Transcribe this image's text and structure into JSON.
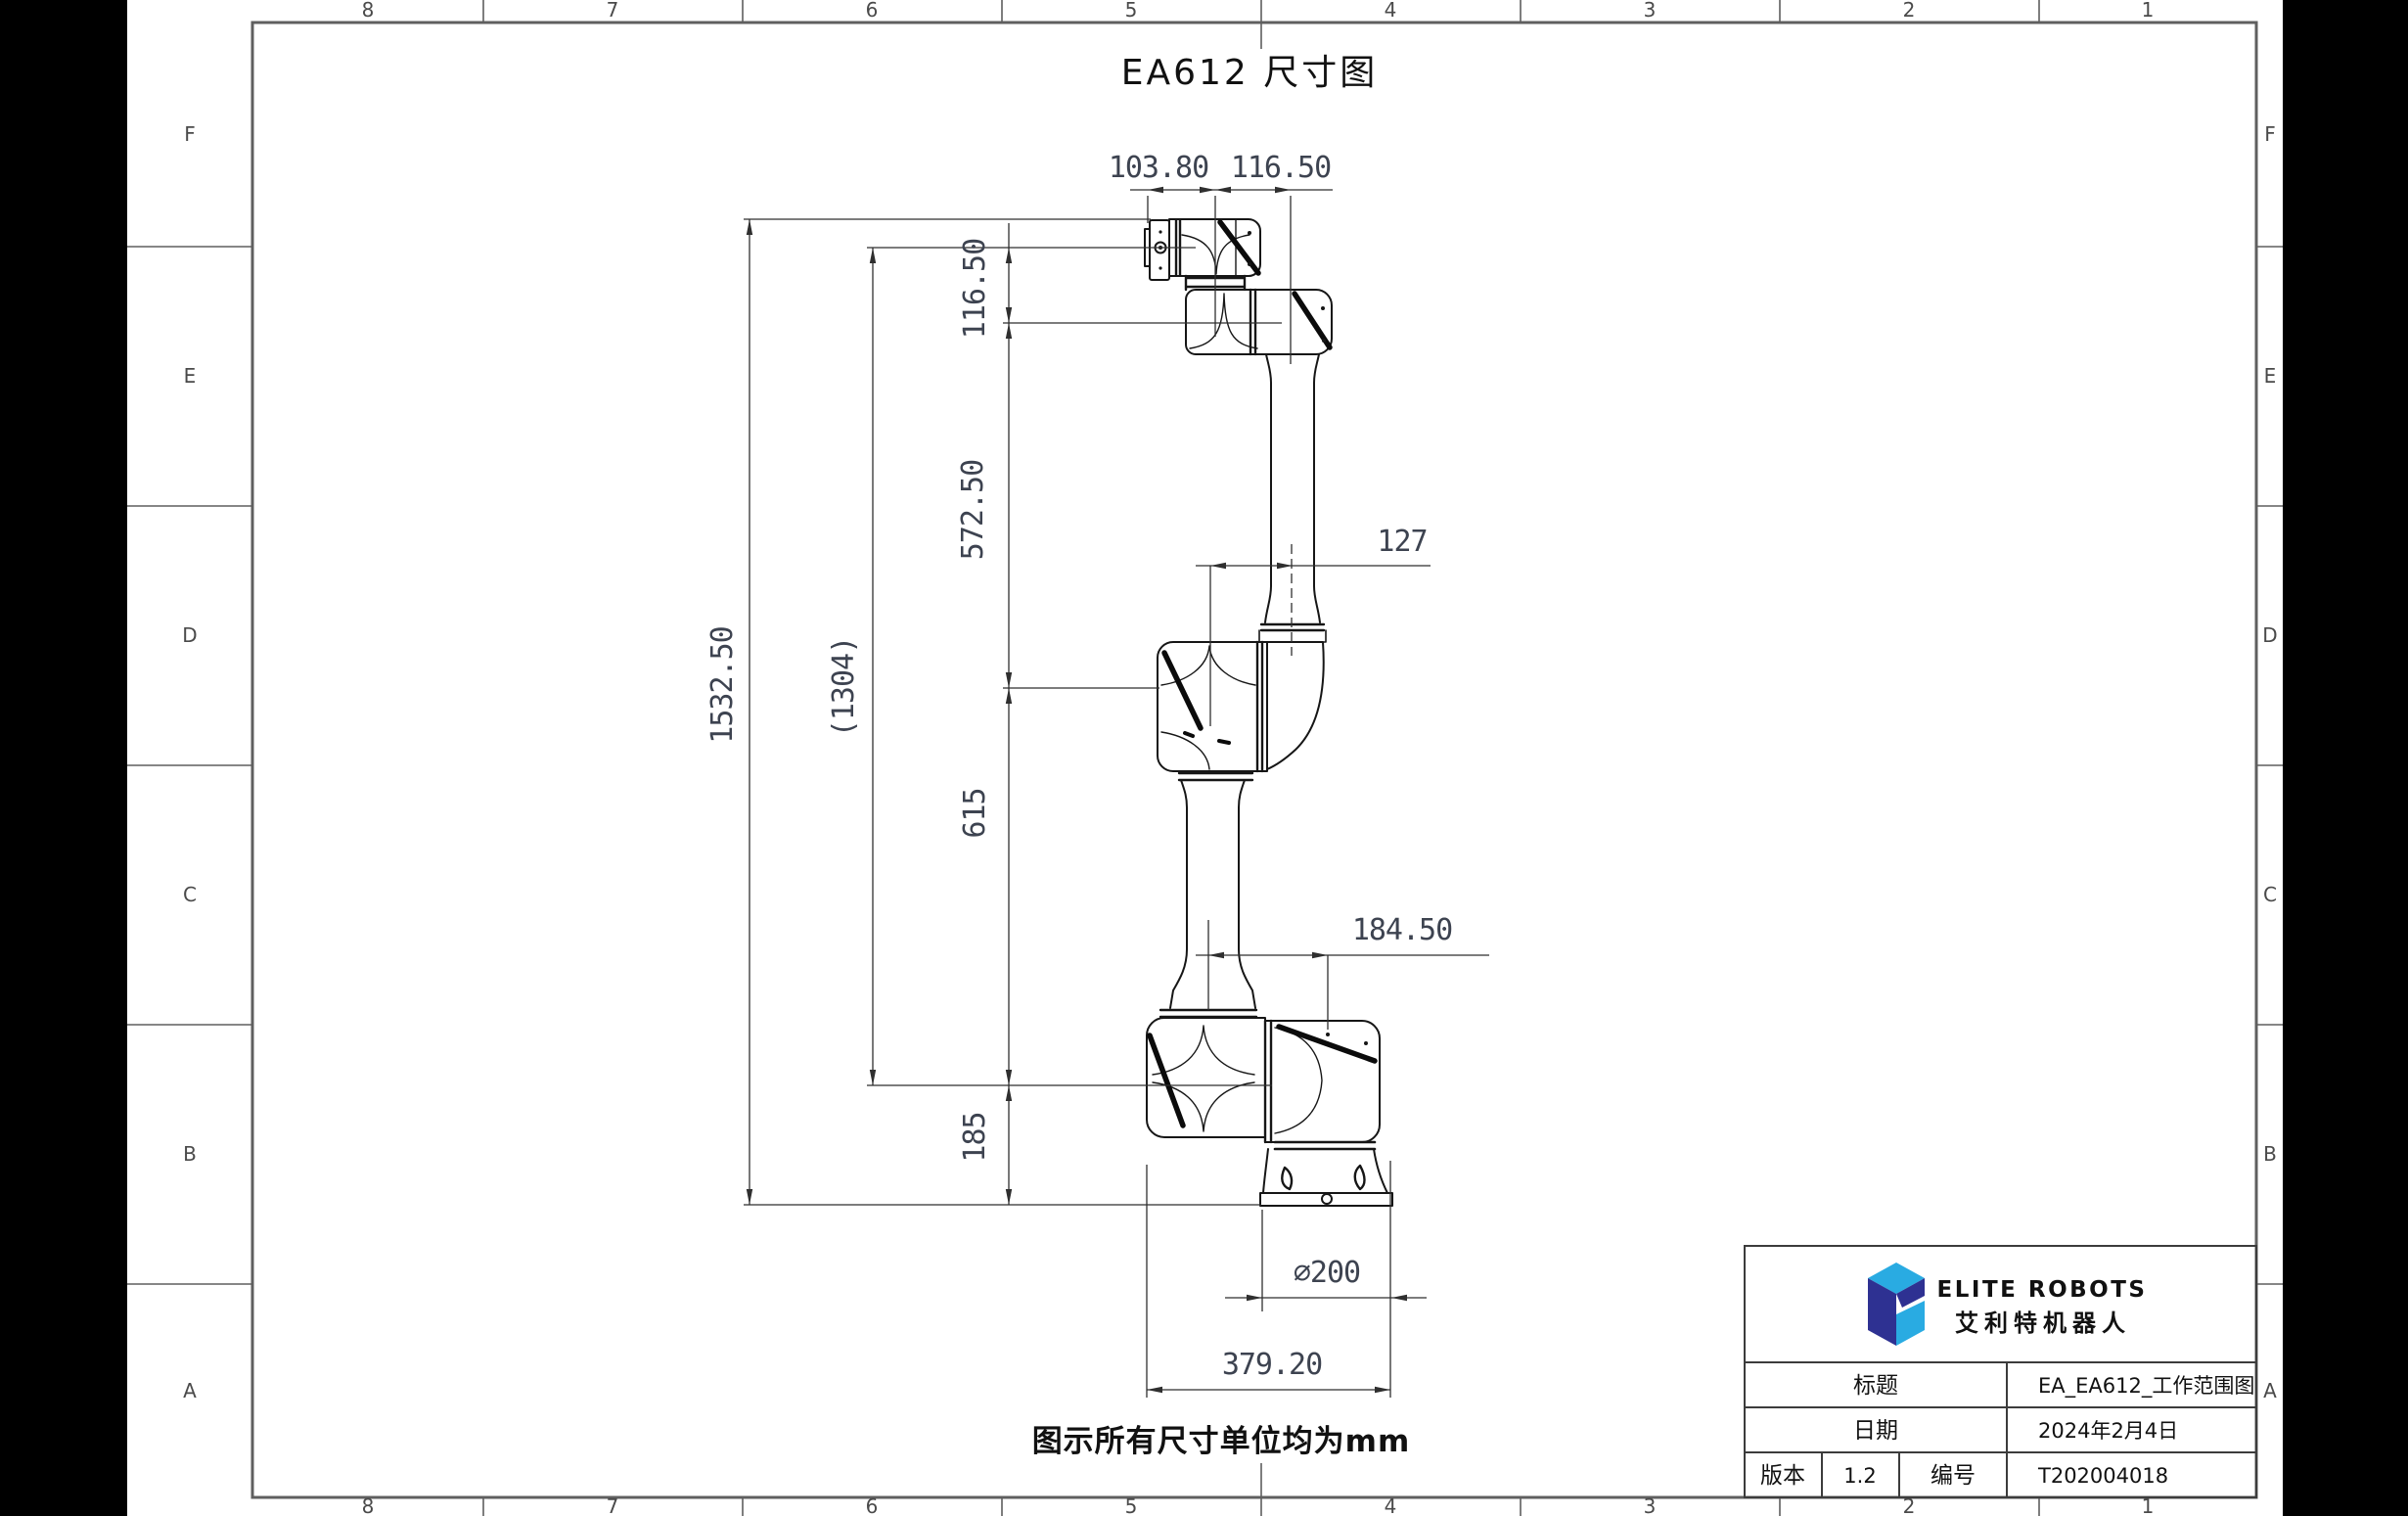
{
  "drawing": {
    "title": "EA612 尺寸图",
    "unit_note": "图示所有尺寸单位均为mm"
  },
  "grid": {
    "columns": [
      "8",
      "7",
      "6",
      "5",
      "4",
      "3",
      "2",
      "1"
    ],
    "rows": [
      "F",
      "E",
      "D",
      "C",
      "B",
      "A"
    ]
  },
  "dimensions": {
    "flange_offset": "103.80",
    "wrist2_offset": "116.50",
    "wrist1_to_wrist2": "116.50",
    "upper_arm": "572.50",
    "total_height": "1532.50",
    "flange_reach": "(1304)",
    "elbow_offset": "127",
    "lower_arm": "615",
    "base_to_shoulder": "185",
    "shoulder_base_offset": "184.50",
    "base_diameter": "∅200",
    "footprint_width": "379.20"
  },
  "title_block": {
    "brand_en": "ELITE ROBOTS",
    "brand_cn": "艾利特机器人",
    "title_label": "标题",
    "title_value": "EA_EA612_工作范围图",
    "date_label": "日期",
    "date_value": "2024年2月4日",
    "version_label": "版本",
    "version_value": "1.2",
    "number_label": "编号",
    "number_value": "T202004018"
  },
  "colors": {
    "logo_light": "#29abe2",
    "logo_dark": "#2e3192",
    "frame": "#5f5f5f",
    "line": "#161616",
    "dim_text": "#3d4350"
  }
}
